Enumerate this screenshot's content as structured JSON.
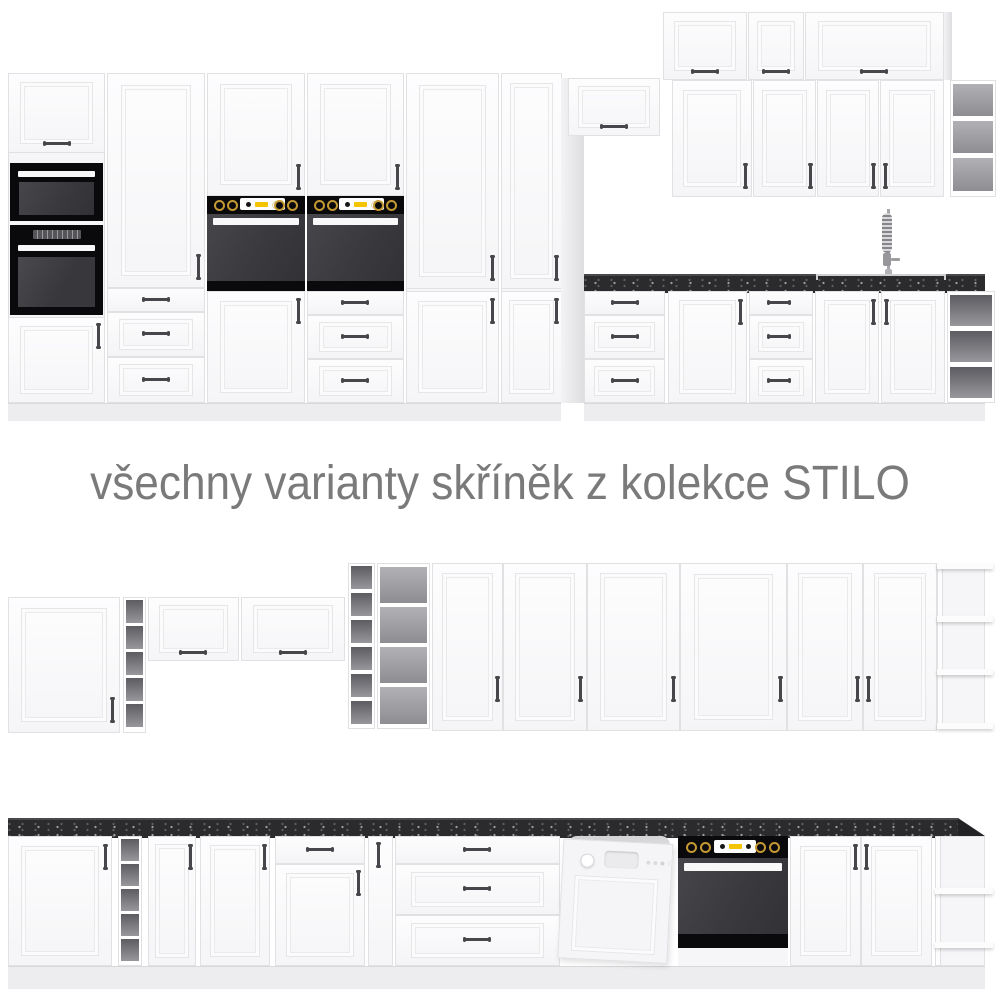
{
  "caption": {
    "text": "všechny varianty skříněk z kolekce STILO"
  },
  "collection": "STILO",
  "palette": {
    "background": "#ffffff",
    "cabinet_white": "#f6f6f8",
    "countertop_black": "#2b2b2d",
    "appliance_black": "#0a0a0c",
    "oven_glass_gray": "#3a3a3e",
    "knob_gold": "#c49833",
    "display_yellow": "#f4c400",
    "shelf_interior_dark": "#5c5c61",
    "shelf_interior_light": "#b0b0b5",
    "caption_gray": "#7a7a7a"
  },
  "scene": {
    "sections": [
      {
        "id": "top-kitchen-run",
        "items": [
          "tall-cabinet-with-microwave-and-oven",
          "tall-cabinet-with-drawers",
          "tall-oven-housing-with-door",
          "tall-oven-housing-with-drawers",
          "tall-double-door-cabinet",
          "tall-narrow-double-door-cabinet",
          "flip-door-wall-cabinet",
          "upper-flip-cabinets",
          "wall-door-cabinets",
          "wall-open-shelf",
          "sink-faucet",
          "black-countertop",
          "base-drawer-units",
          "base-door-cabinets",
          "base-open-shelf"
        ]
      },
      {
        "id": "wall-units-row",
        "items": [
          "square-wall-cabinet",
          "narrow-shelf-column",
          "flip-door-wall-cabinet",
          "flip-door-wall-cabinet",
          "tall-narrow-shelf-column",
          "tall-open-shelf",
          "six-tall-door-cabinets",
          "open-end-shelf"
        ]
      },
      {
        "id": "base-units-row",
        "items": [
          "black-countertop",
          "door-cabinet",
          "narrow-shelf-column",
          "narrow-door-cabinet",
          "door-cabinet",
          "drawer-door-cabinet",
          "narrow-pullout-cabinet",
          "three-drawer-unit",
          "dishwasher",
          "built-in-oven",
          "double-door-cabinet",
          "open-end-corner-shelf"
        ]
      }
    ]
  }
}
